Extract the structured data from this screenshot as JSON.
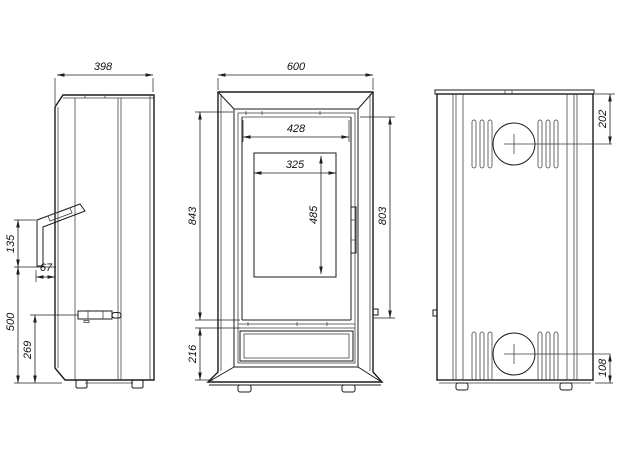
{
  "colors": {
    "line": "#1b1b1b",
    "thin_line": "#3a3a3a",
    "dimension_line": "#1f1f1f",
    "text": "#111111",
    "background": "#ffffff"
  },
  "views": {
    "side": {
      "dims": {
        "depth": "398",
        "handle_length": "135",
        "handle_offset": "67",
        "handle_height": "500",
        "lever_height": "269"
      }
    },
    "front": {
      "dims": {
        "width": "600",
        "door_opening_width": "428",
        "glass_width": "325",
        "glass_height": "485",
        "body_height": "843",
        "door_height": "803",
        "plinth_height": "216"
      }
    },
    "rear": {
      "dims": {
        "flue_offset_top": "202",
        "inlet_offset_bottom": "108"
      }
    }
  }
}
